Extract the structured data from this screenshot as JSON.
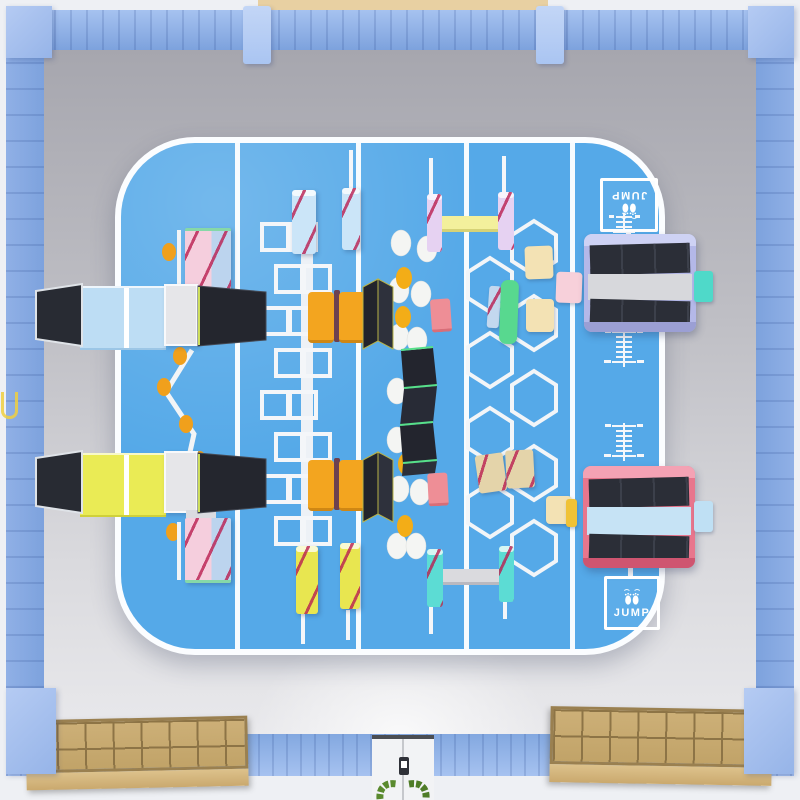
{
  "scene": {
    "signs": {
      "jump_top": "JUMP",
      "jump_bottom": "JUMP"
    },
    "palette": {
      "wall_blue": "#8fb0e6",
      "pillar_blue": "#b7cef4",
      "floor_gray": "#c2c2c8",
      "court_blue": "#55a9e8",
      "court_line_white": "#ffffff",
      "mat_light_blue": "#bdddf4",
      "mat_yellow": "#eaeb55",
      "slide_black": "#282b33",
      "tower_pink": "#f5cedd",
      "block_orange": "#f3a51f",
      "post_light_blue": "#cbe5f8",
      "post_yellow": "#e8e650",
      "post_lavender": "#e6d2f2",
      "post_cyan": "#5cdcd4",
      "beam_yellow": "#f3f09c",
      "beam_gray": "#dadade",
      "pad_green": "#58d88f",
      "pad_cream": "#f3e2b4",
      "pad_pink": "#f7d0da",
      "pad_teal": "#4fd9c9",
      "tramp_frame_periwinkle": "#b4b8e8",
      "tramp_frame_pink": "#e8768d",
      "dot_white": "#f4f5f3",
      "dot_yellow": "#f3ad17",
      "dot_orange": "#f0a01c",
      "cubby_wood": "#c9ab72",
      "door_white": "#f2f3f5",
      "plant_green": "#55822a",
      "exterior_tan": "#e8d0a2"
    },
    "equipment": [
      {
        "name": "climbing-tower-pink",
        "count": 2
      },
      {
        "name": "slide-platform-light-blue",
        "count": 1
      },
      {
        "name": "slide-platform-yellow",
        "count": 1
      },
      {
        "name": "zigzag-stepping-path",
        "count": 1
      },
      {
        "name": "hopscotch-square-course",
        "count": 1
      },
      {
        "name": "padded-post-light-blue",
        "count": 2
      },
      {
        "name": "padded-post-yellow",
        "count": 2
      },
      {
        "name": "vault-block-orange",
        "count": 4
      },
      {
        "name": "stepping-dots-trail",
        "count": 1
      },
      {
        "name": "folded-wedge-black",
        "count": 2
      },
      {
        "name": "wave-balance-beam",
        "count": 1
      },
      {
        "name": "landing-mat-pink",
        "count": 2
      },
      {
        "name": "balance-beam-yellow",
        "count": 1
      },
      {
        "name": "balance-beam-gray",
        "count": 1
      },
      {
        "name": "honeycomb-climb-course",
        "count": 1
      },
      {
        "name": "wall-trampoline-station",
        "count": 2
      },
      {
        "name": "height-ruler-marking",
        "count": 3
      },
      {
        "name": "jump-sign",
        "count": 2
      },
      {
        "name": "shoe-cubby-shelf",
        "count": 2
      },
      {
        "name": "entrance-double-door",
        "count": 1
      },
      {
        "name": "door-plant",
        "count": 2
      }
    ]
  }
}
